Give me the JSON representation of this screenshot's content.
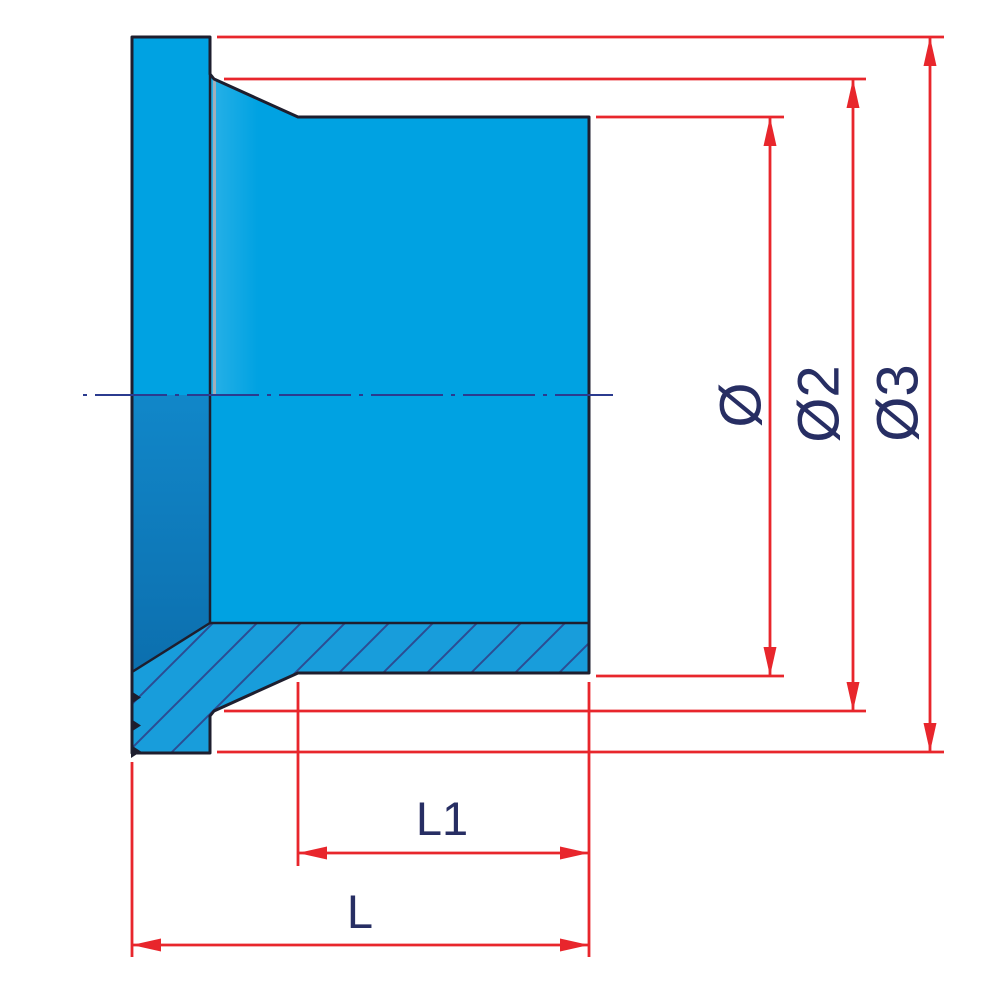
{
  "labels": {
    "dia": "Ø",
    "dia2": "Ø2",
    "dia3": "Ø3",
    "len1": "L1",
    "len": "L"
  },
  "colors": {
    "part_fill": "#00A2E2",
    "part_fill_dark1": "#1187C9",
    "part_fill_dark2": "#0C6FAE",
    "hatch_fill": "#189DDB",
    "hatch_line": "#2B4D93",
    "outline": "#1E1E2E",
    "dimension_red": "#E8262C",
    "label_navy": "#272E63",
    "centerline_navy": "#2B3B8F",
    "tangent_gray": "#A3AEB8"
  }
}
